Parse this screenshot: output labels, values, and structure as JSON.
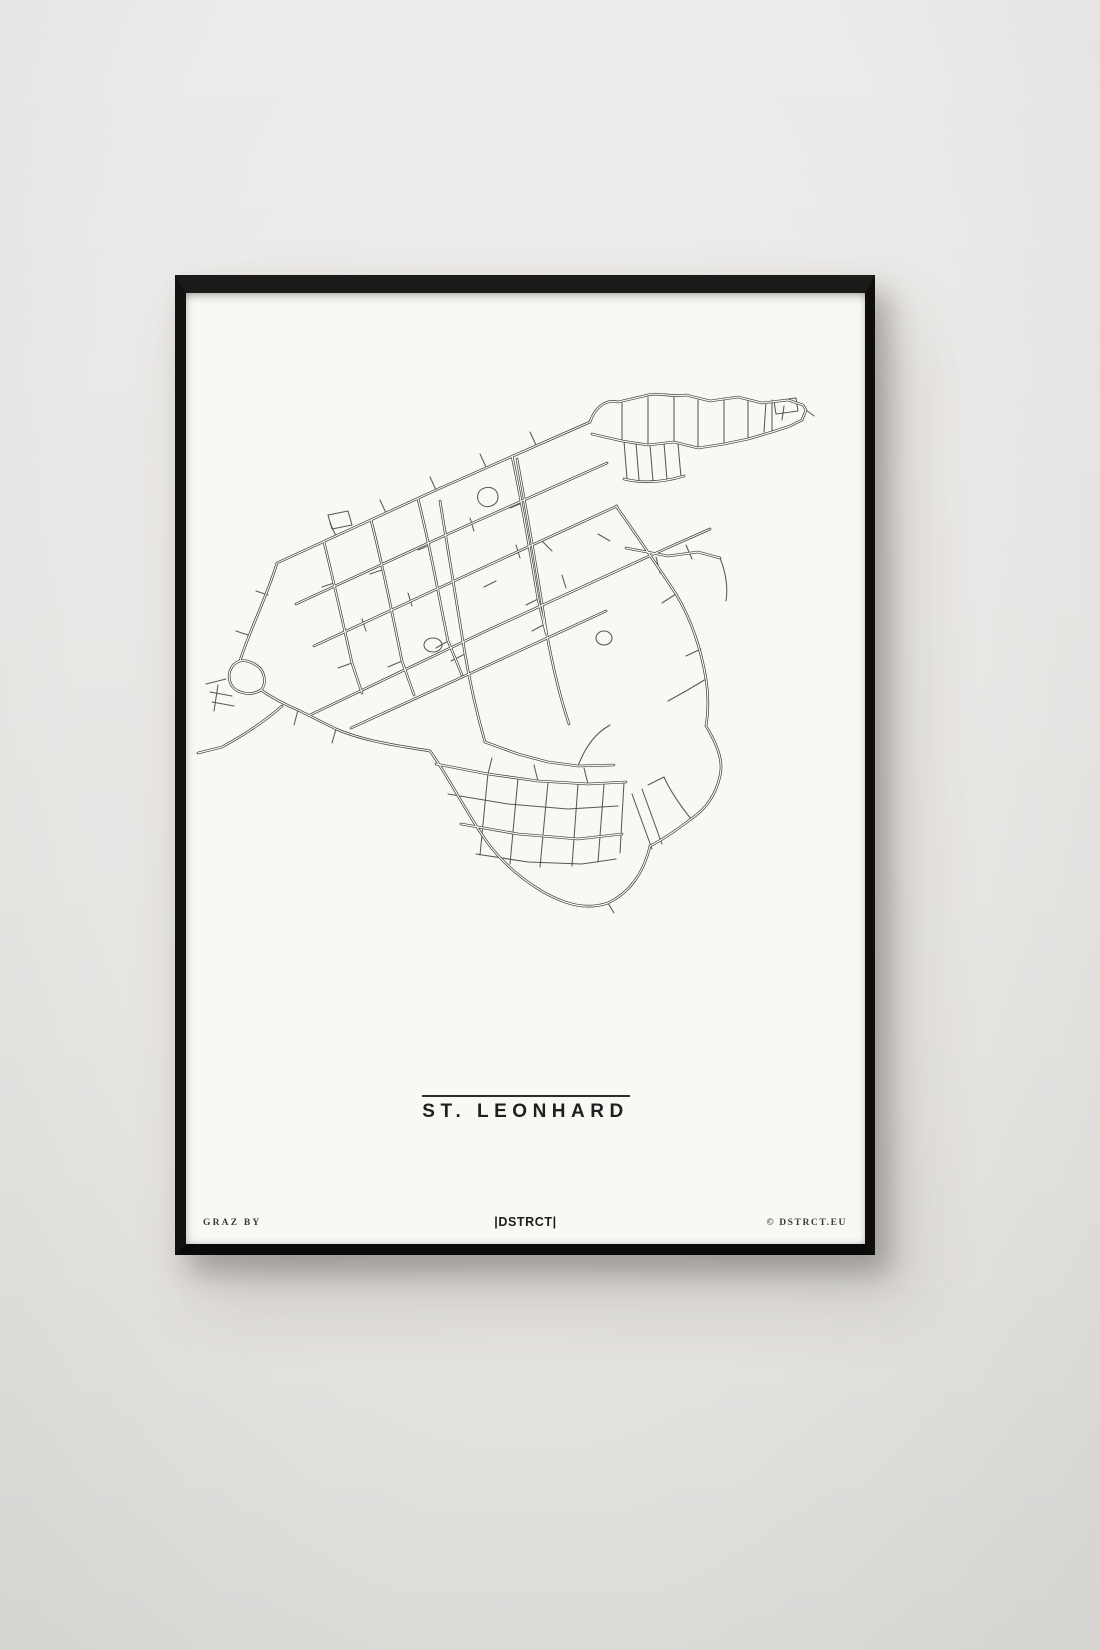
{
  "scene": {
    "wall_color": "#e9e7e5",
    "frame_color": "#121110",
    "poster_color": "#f9f8f5"
  },
  "poster": {
    "title": "ST. LEONHARD",
    "footer_left": "GRAZ BY",
    "footer_center": "|DSTRCT|",
    "footer_right": "© DSTRCT.EU"
  },
  "map": {
    "name": "st-leonhard-street-map",
    "stroke_color": "#3a3a3a",
    "casing_color": "#f9f8f5",
    "main_paths": [
      "M91,270 L250,197 404,129",
      "M404,129 C409,114 420,106 432,109 L458,103 C472,98 486,105 500,102 L524,108 552,104 576,110 602,107 617,112 L620,117 616,127",
      "M406,141 L436,148 462,152 488,149 512,155 538,151 562,146 586,139 604,133 616,127",
      "M124,422 L300,338 470,260 524,236",
      "M254,208 C263,262 271,312 279,361 C285,396 291,421 299,449",
      "M331,166 C341,221 351,276 359,331 C365,366 373,401 383,431",
      "M430,213 C450,241 470,271 490,301 C505,326 515,356 520,386 C523,406 522,421 520,433",
      "M520,433 C534,456 537,471 534,483 C530,501 520,516 505,526 C492,536 478,546 464,553",
      "M464,553 C458,578 445,599 422,610",
      "M244,458 C261,481 281,521 301,549 C321,576 351,599 379,609 C396,615 410,614 422,610",
      "M91,270 C82,301 62,341 54,368",
      "M54,368 C44,371 40,383 46,393 C52,401 66,403 75,397 C81,391 79,377 70,372 C64,368 58,367 54,368",
      "M75,397 C88,406 100,412 112,417 L150,436 C180,449 215,453 244,458",
      "M96,413 C78,429 58,442 36,454 L12,460",
      "M110,311 L262,241 421,170",
      "M128,353 L281,282 431,213",
      "M165,435 L320,364 420,318",
      "M185,227 C197,273 206,320 216,368 L228,402",
      "M232,206 C244,252 252,300 262,348 L276,382",
      "M138,249 C148,290 157,330 166,370 L176,400",
      "M326,163 C336,210 344,258 352,306 L360,340",
      "M299,449 L332,461 362,469 392,473 428,472",
      "M250,471 L302,481 352,488 402,491 440,489",
      "M275,531 L332,541 392,546 436,541",
      "M438,186 C458,191 478,189 498,183",
      "M440,255 L482,263 512,259 534,265"
    ],
    "minor_paths": [
      "M436,110 L436,148",
      "M462,104 L462,152",
      "M488,103 L488,149",
      "M512,107 L512,155",
      "M538,105 L538,151",
      "M562,108 L562,146",
      "M586,107 L586,139",
      "M438,148 L441,186",
      "M450,150 L453,187",
      "M464,152 L467,188",
      "M478,150 L481,187",
      "M492,151 L495,184",
      "M598,113 L596,127",
      "M580,109 L578,139",
      "M588,108 L610,105 612,118 590,121 Z",
      "M620,117 L628,123",
      "M302,480 L294,562",
      "M332,485 L324,571",
      "M362,489 L354,574",
      "M392,491 L386,573",
      "M418,491 L412,569",
      "M438,489 L434,560",
      "M262,501 L322,511 382,516 432,513",
      "M290,561 L342,569 396,571 430,566",
      "M446,501 L466,556",
      "M456,496 L476,551",
      "M166,370 L152,375",
      "M216,368 L202,374",
      "M262,348 L250,355",
      "M352,306 L340,312",
      "M279,361 L265,368",
      "M359,331 L346,338",
      "M196,277 L184,281",
      "M244,252 L232,257",
      "M148,290 L136,294",
      "M310,288 L298,294",
      "M366,258 L356,248",
      "M336,210 L324,215",
      "M412,241 L424,248",
      "M284,225 L288,238",
      "M330,252 L334,265",
      "M376,282 L380,295",
      "M222,300 L226,313",
      "M176,326 L180,338",
      "M250,197 L244,184",
      "M300,174 L294,161",
      "M350,152 L344,139",
      "M200,220 L194,207",
      "M150,243 L144,230",
      "M470,264 L474,280",
      "M500,252 L506,266",
      "M490,301 L476,310",
      "M515,356 L500,363",
      "M534,265 C540,280 542,295 540,308",
      "M520,386 L500,398 482,408",
      "M392,473 C400,452 410,440 424,432",
      "M24,399 L46,403",
      "M26,409 L48,413",
      "M32,392 L28,418",
      "M40,386 L20,391",
      "M62,342 L50,338",
      "M82,302 L70,298",
      "M112,417 L108,432",
      "M150,436 L146,450",
      "M142,222 L162,218 166,232 146,236 Z",
      "M296,196 C304,192 312,196 312,204 C312,212 302,216 296,212 C290,208 290,200 296,196 Z",
      "M238,352 a9,7 0 1,0 18,0 a9,7 0 1,0 -18,0",
      "M410,345 a8,7 0 1,0 16,0 a8,7 0 1,0 -16,0",
      "M352,488 L348,472",
      "M402,491 L398,475",
      "M302,481 L306,465",
      "M505,526 C494,512 484,498 478,484",
      "M478,484 L462,492",
      "M422,610 L428,620"
    ]
  }
}
